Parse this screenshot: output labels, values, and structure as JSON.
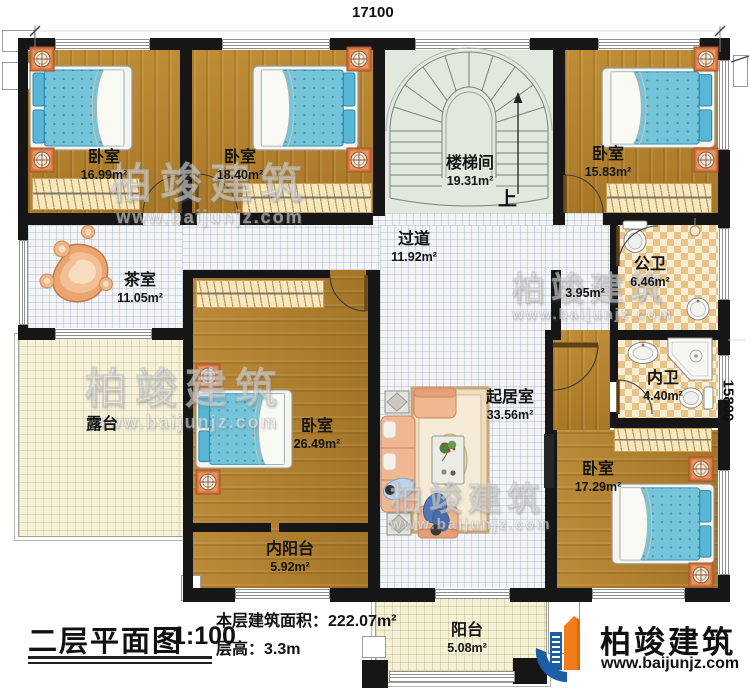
{
  "dimensions": {
    "top": "17100",
    "right": "15800"
  },
  "rooms": {
    "bedroom_tl": {
      "name": "卧室",
      "area": "16.99m²"
    },
    "bedroom_tm": {
      "name": "卧室",
      "area": "18.40m²"
    },
    "stairwell": {
      "name": "楼梯间",
      "area": "19.31m²",
      "direction": "上"
    },
    "bedroom_tr": {
      "name": "卧室",
      "area": "15.83m²"
    },
    "tea_room": {
      "name": "茶室",
      "area": "11.05m²"
    },
    "corridor": {
      "name": "过道",
      "area": "11.92m²"
    },
    "lobby": {
      "area": "3.95m²"
    },
    "public_bath": {
      "name": "公卫",
      "area": "6.46m²"
    },
    "private_bath": {
      "name": "内卫",
      "area": "4.40m²"
    },
    "terrace": {
      "name": "露台"
    },
    "bedroom_ml": {
      "name": "卧室",
      "area": "26.49m²"
    },
    "living_room": {
      "name": "起居室",
      "area": "33.56m²"
    },
    "inner_balcony": {
      "name": "内阳台",
      "area": "5.92m²"
    },
    "bedroom_br": {
      "name": "卧室",
      "area": "17.29m²"
    },
    "balcony": {
      "name": "阳台",
      "area": "5.08m²"
    }
  },
  "title_block": {
    "title": "二层平面图",
    "scale": "1:100",
    "floor_area": "本层建筑面积：222.07m²",
    "floor_height": "层高：3.3m"
  },
  "brand": {
    "name": "柏竣建筑",
    "website": "www.baijunjz.com"
  },
  "watermark": {
    "name": "柏竣建筑",
    "website": "www.baijunjz.com"
  },
  "colors": {
    "wall": "#161616",
    "wood_floor": "#b5832d",
    "mattress": "#74c4da",
    "stair_floor": "#e1e8de",
    "bath_tile": "#e9c285",
    "outdoor_floor": "#f5f1d8",
    "brand_blue": "#1b5ea5",
    "brand_orange": "#f07c1a"
  }
}
